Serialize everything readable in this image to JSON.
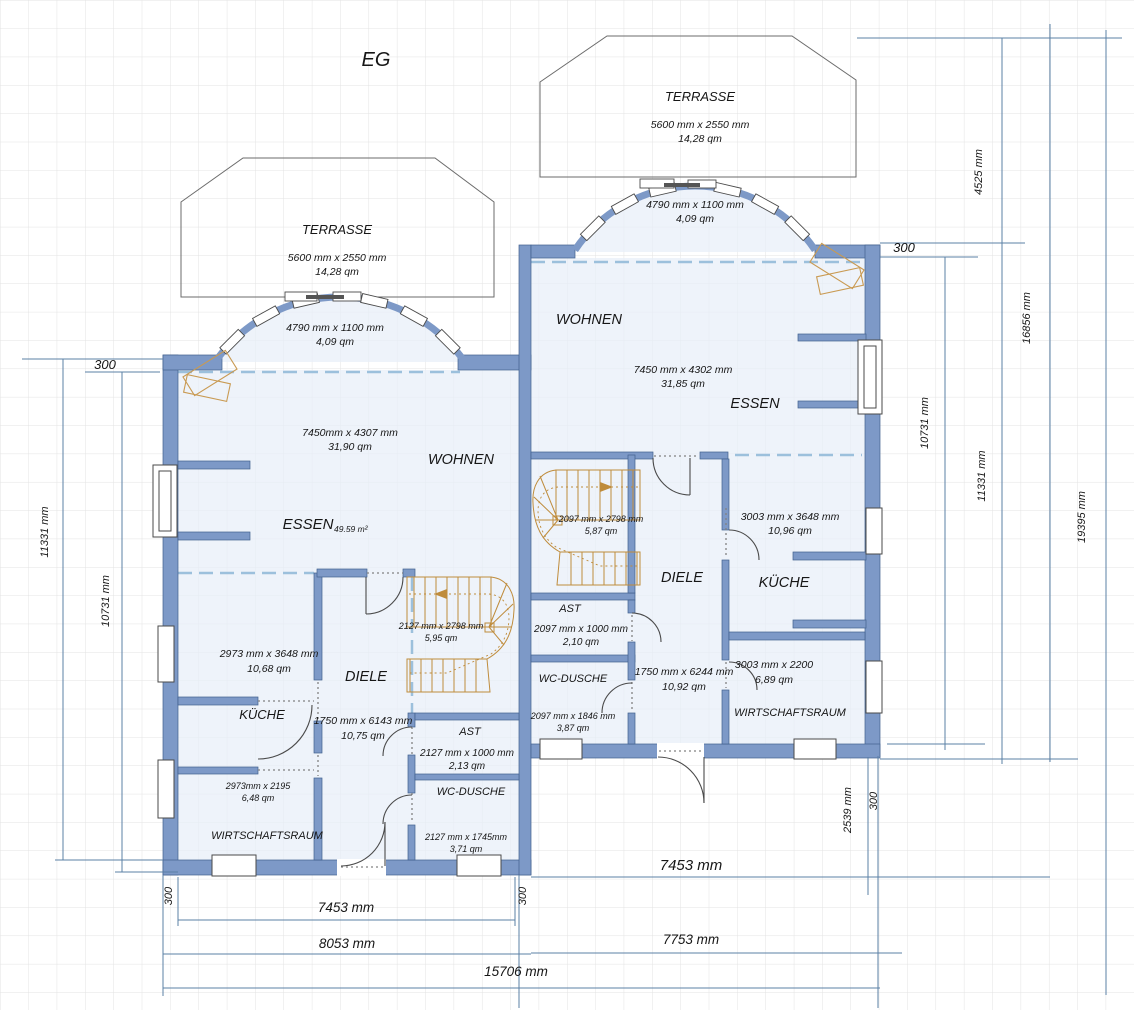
{
  "title": "EG",
  "colors": {
    "wall": "#7d99c7",
    "wall_edge": "#41608e",
    "room_fill": "#e8eef8",
    "stair": "#bf8c3c",
    "furniture": "#c99a52",
    "dimension_line": "#5b80a6",
    "dashed_open": "#9cc0dc",
    "grid": "#e3e3e3",
    "terrace_outline": "#6b6b6b",
    "door": "#4a4a4a"
  },
  "units": {
    "left": {
      "terrace": {
        "label": "TERRASSE",
        "size": "5600 mm x 2550 mm",
        "area": "14,28 qm"
      },
      "bay": {
        "size": "4790 mm x 1100 mm",
        "area": "4,09 qm"
      },
      "wohnen": {
        "label": "WOHNEN",
        "size": "7450mm x 4307 mm",
        "area": "31,90 qm"
      },
      "essen": {
        "label": "ESSEN",
        "area": "49.59 m²"
      },
      "kueche": {
        "label": "KÜCHE",
        "size": "2973 mm x 3648 mm",
        "area": "10,68 qm"
      },
      "diele": {
        "label": "DIELE",
        "size": "1750 mm x 6143 mm",
        "area": "10,75 qm"
      },
      "stairs": {
        "size": "2127 mm x 2798 mm",
        "area": "5,95 qm"
      },
      "ast": {
        "label": "AST",
        "size": "2127 mm x 1000 mm",
        "area": "2,13 qm"
      },
      "wc": {
        "label": "WC-DUSCHE",
        "size": "2127 mm x 1745mm",
        "area": "3,71 qm"
      },
      "hwr": {
        "label": "WIRTSCHAFTSRAUM",
        "size": "2973mm x 2195",
        "area": "6,48 qm"
      }
    },
    "right": {
      "terrace": {
        "label": "TERRASSE",
        "size": "5600 mm x 2550 mm",
        "area": "14,28 qm"
      },
      "bay": {
        "size": "4790 mm x 1100 mm",
        "area": "4,09 qm"
      },
      "wohnen": {
        "label": "WOHNEN",
        "size": "7450 mm x 4302 mm",
        "area": "31,85 qm"
      },
      "essen": {
        "label": "ESSEN"
      },
      "kueche": {
        "label": "KÜCHE",
        "size": "3003 mm x 3648 mm",
        "area": "10,96 qm"
      },
      "diele": {
        "label": "DIELE",
        "size": "1750 mm x 6244 mm",
        "area": "10,92 qm"
      },
      "stairs": {
        "size": "2097 mm x 2798 mm",
        "area": "5,87 qm"
      },
      "ast": {
        "label": "AST",
        "size": "2097 mm x 1000 mm",
        "area": "2,10 qm"
      },
      "wc": {
        "label": "WC-DUSCHE",
        "size": "2097 mm x 1846 mm",
        "area": "3,87 qm"
      },
      "hwr": {
        "label": "WIRTSCHAFTSRAUM",
        "size": "3003 mm x 2200",
        "area": "6,89 qm"
      }
    }
  },
  "dims": {
    "left_300": "300",
    "left_11331": "11331 mm",
    "left_10731": "10731 mm",
    "bottom_left_300": "300",
    "bottom_7453": "7453 mm",
    "bottom_mid_300": "300",
    "bottom_8053": "8053 mm",
    "bottom_15706": "15706 mm",
    "right_unit_7453": "7453 mm",
    "right_unit_7753": "7753 mm",
    "right_2539": "2539 mm",
    "right_300_bottom": "300",
    "right_4525": "4525 mm",
    "right_300_top": "300",
    "right_16856": "16856 mm",
    "right_10731": "10731 mm",
    "right_11331": "11331 mm",
    "right_19395": "19395 mm"
  }
}
